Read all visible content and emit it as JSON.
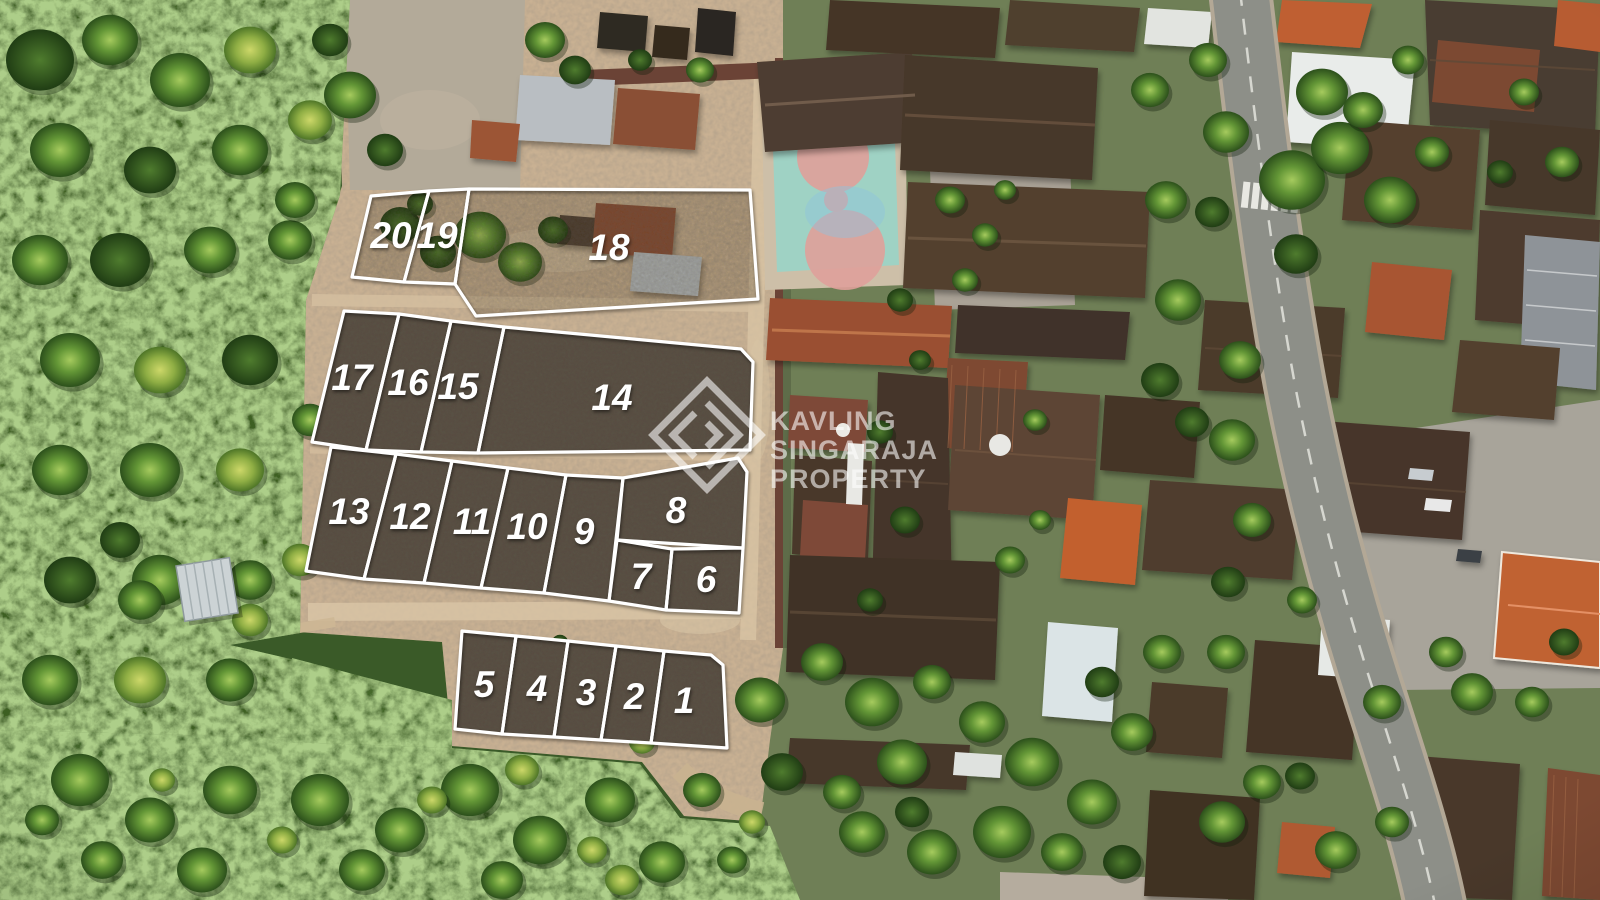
{
  "scene_type": "aerial-drone-photo-of-land-plot-subdivision",
  "watermark": {
    "logo": "kavling-singaraja-property-monogram",
    "lines": [
      "KAVLING",
      "SINGARAJA",
      "PROPERTY"
    ]
  },
  "plots": [
    {
      "number": "20",
      "points": "371,196 429,191 404,282 352,277",
      "label": [
        391,
        248
      ],
      "cleared": false
    },
    {
      "number": "19",
      "points": "429,191 469,189 455,284 404,282",
      "label": [
        437,
        248
      ],
      "cleared": false
    },
    {
      "number": "18",
      "points": "469,189 750,190 758,299 476,316 455,284",
      "label": [
        609,
        260
      ],
      "cleared": false
    },
    {
      "number": "17",
      "points": "344,311 399,314 366,450 312,442",
      "label": [
        352,
        390
      ],
      "cleared": true
    },
    {
      "number": "16",
      "points": "399,314 451,321 421,452 366,450",
      "label": [
        408,
        395
      ],
      "cleared": true
    },
    {
      "number": "15",
      "points": "451,321 504,327 478,453 421,452",
      "label": [
        458,
        399
      ],
      "cleared": true
    },
    {
      "number": "14",
      "points": "504,327 741,349 753,362 750,450 478,453",
      "label": [
        612,
        410
      ],
      "cleared": true
    },
    {
      "number": "13",
      "points": "331,447 396,454 364,579 306,571",
      "label": [
        349,
        524
      ],
      "cleared": true
    },
    {
      "number": "12",
      "points": "396,454 452,461 424,583 364,579",
      "label": [
        410,
        529
      ],
      "cleared": true
    },
    {
      "number": "11",
      "points": "452,461 508,468 481,588 424,583",
      "label": [
        472,
        534
      ],
      "cleared": true
    },
    {
      "number": "10",
      "points": "508,468 566,475 544,593 481,588",
      "label": [
        527,
        539
      ],
      "cleared": true
    },
    {
      "number": "9",
      "points": "566,475 623,478 609,601 544,593",
      "label": [
        584,
        544
      ],
      "cleared": true
    },
    {
      "number": "8",
      "points": "623,478 738,458 747,472 743,548 617,540",
      "label": [
        676,
        523
      ],
      "cleared": true
    },
    {
      "number": "7",
      "points": "617,540 672,549 666,610 609,601",
      "label": [
        641,
        589
      ],
      "cleared": true
    },
    {
      "number": "6",
      "points": "672,549 743,548 739,613 666,610",
      "label": [
        706,
        592
      ],
      "cleared": true
    },
    {
      "number": "5",
      "points": "462,631 516,636 502,734 455,729",
      "label": [
        484,
        697
      ],
      "cleared": true
    },
    {
      "number": "4",
      "points": "516,636 568,641 554,737 502,734",
      "label": [
        537,
        701
      ],
      "cleared": true
    },
    {
      "number": "3",
      "points": "568,641 616,646 601,740 554,737",
      "label": [
        586,
        705
      ],
      "cleared": true
    },
    {
      "number": "2",
      "points": "616,646 664,651 651,743 601,740",
      "label": [
        634,
        709
      ],
      "cleared": true
    },
    {
      "number": "1",
      "points": "664,651 711,655 723,665 727,748 651,743",
      "label": [
        684,
        713
      ],
      "cleared": true
    }
  ],
  "palette": {
    "plot_line": "#ffffff",
    "plot_number": "#ffffff",
    "cleared_soil": "#584e42",
    "uncleared_tint": "rgba(62,52,40,0.22)",
    "dirt_road": "#c9b193",
    "vegetation": "#3c5f24",
    "village_ground": "#6f7f56",
    "dark_roof": "#4a3a2c",
    "orange_roof": "#c06233",
    "rust_roof": "#7e4a33",
    "white_roof": "#e9ecea",
    "asphalt": "#8d8f88",
    "court_teal": "#9fd2c4",
    "court_pink": "#dfa09a",
    "watermark_color": "#ffffff"
  }
}
